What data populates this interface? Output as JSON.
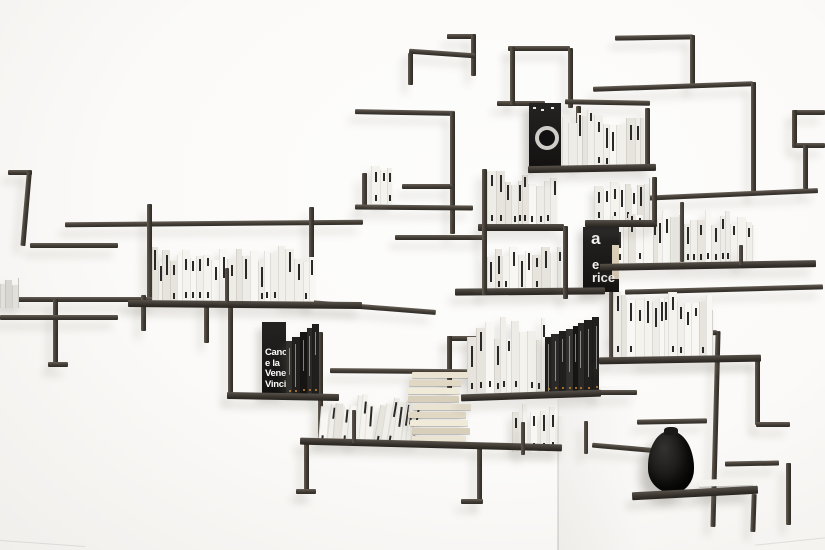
{
  "scene": {
    "background_color": "#fbfaf8",
    "metal_color": "#45403a",
    "shadow_color": "#b9b4ac",
    "vase_color": "#111010",
    "accent_dot_color": "#c8882e",
    "white_book_color": "#f3f1ec",
    "black_book_color": "#1b1a19"
  },
  "texts": {
    "black_book_cover_lines": [
      "Canov",
      "e la",
      "Vener",
      "Vincit"
    ],
    "black_display_book_lines": [
      "a",
      "e",
      "rice"
    ]
  },
  "objects": [
    {
      "id": "rod-structure",
      "label": "dark steel rod wall shelving"
    },
    {
      "id": "white-books",
      "label": "rows of white paperback books"
    },
    {
      "id": "black-books",
      "label": "black art books"
    },
    {
      "id": "record-box",
      "label": "black box with circular label"
    },
    {
      "id": "vase",
      "label": "black textured vase"
    }
  ],
  "book_groups": {
    "left-shelf-books": {
      "count": 30,
      "palette": "white"
    },
    "top-record-books": {
      "count": 14,
      "palette": "white"
    },
    "small-upper-stack": {
      "count": 4,
      "palette": "white"
    },
    "center-upper-left-books": {
      "count": 12,
      "palette": "white"
    },
    "center-upper-right-books": {
      "count": 10,
      "palette": "white"
    },
    "center-mid-books": {
      "count": 13,
      "palette": "white"
    },
    "right-long-row-books": {
      "count": 24,
      "palette": "white"
    },
    "right-mid-books": {
      "count": 17,
      "palette": "white"
    },
    "center-lower-white-books": {
      "count": 13,
      "palette": "white"
    },
    "center-lower-dark-books": {
      "count": 8,
      "palette": "dark",
      "stair": true
    },
    "canova-spines": {
      "count": 5,
      "palette": "dark",
      "stair": true
    },
    "leaning-books": {
      "count": 15,
      "palette": "white",
      "lean": 9
    },
    "flat-stack-books": {
      "count": 9,
      "palette": "cream",
      "orientation": "horizontal"
    },
    "corner-books": {
      "count": 6,
      "palette": "white",
      "gap": 3
    },
    "vase-shelf-books": {
      "count": 2,
      "palette": "white",
      "orientation": "horizontal"
    },
    "left-edge-stack": {
      "count": 4,
      "palette": "gray"
    }
  }
}
